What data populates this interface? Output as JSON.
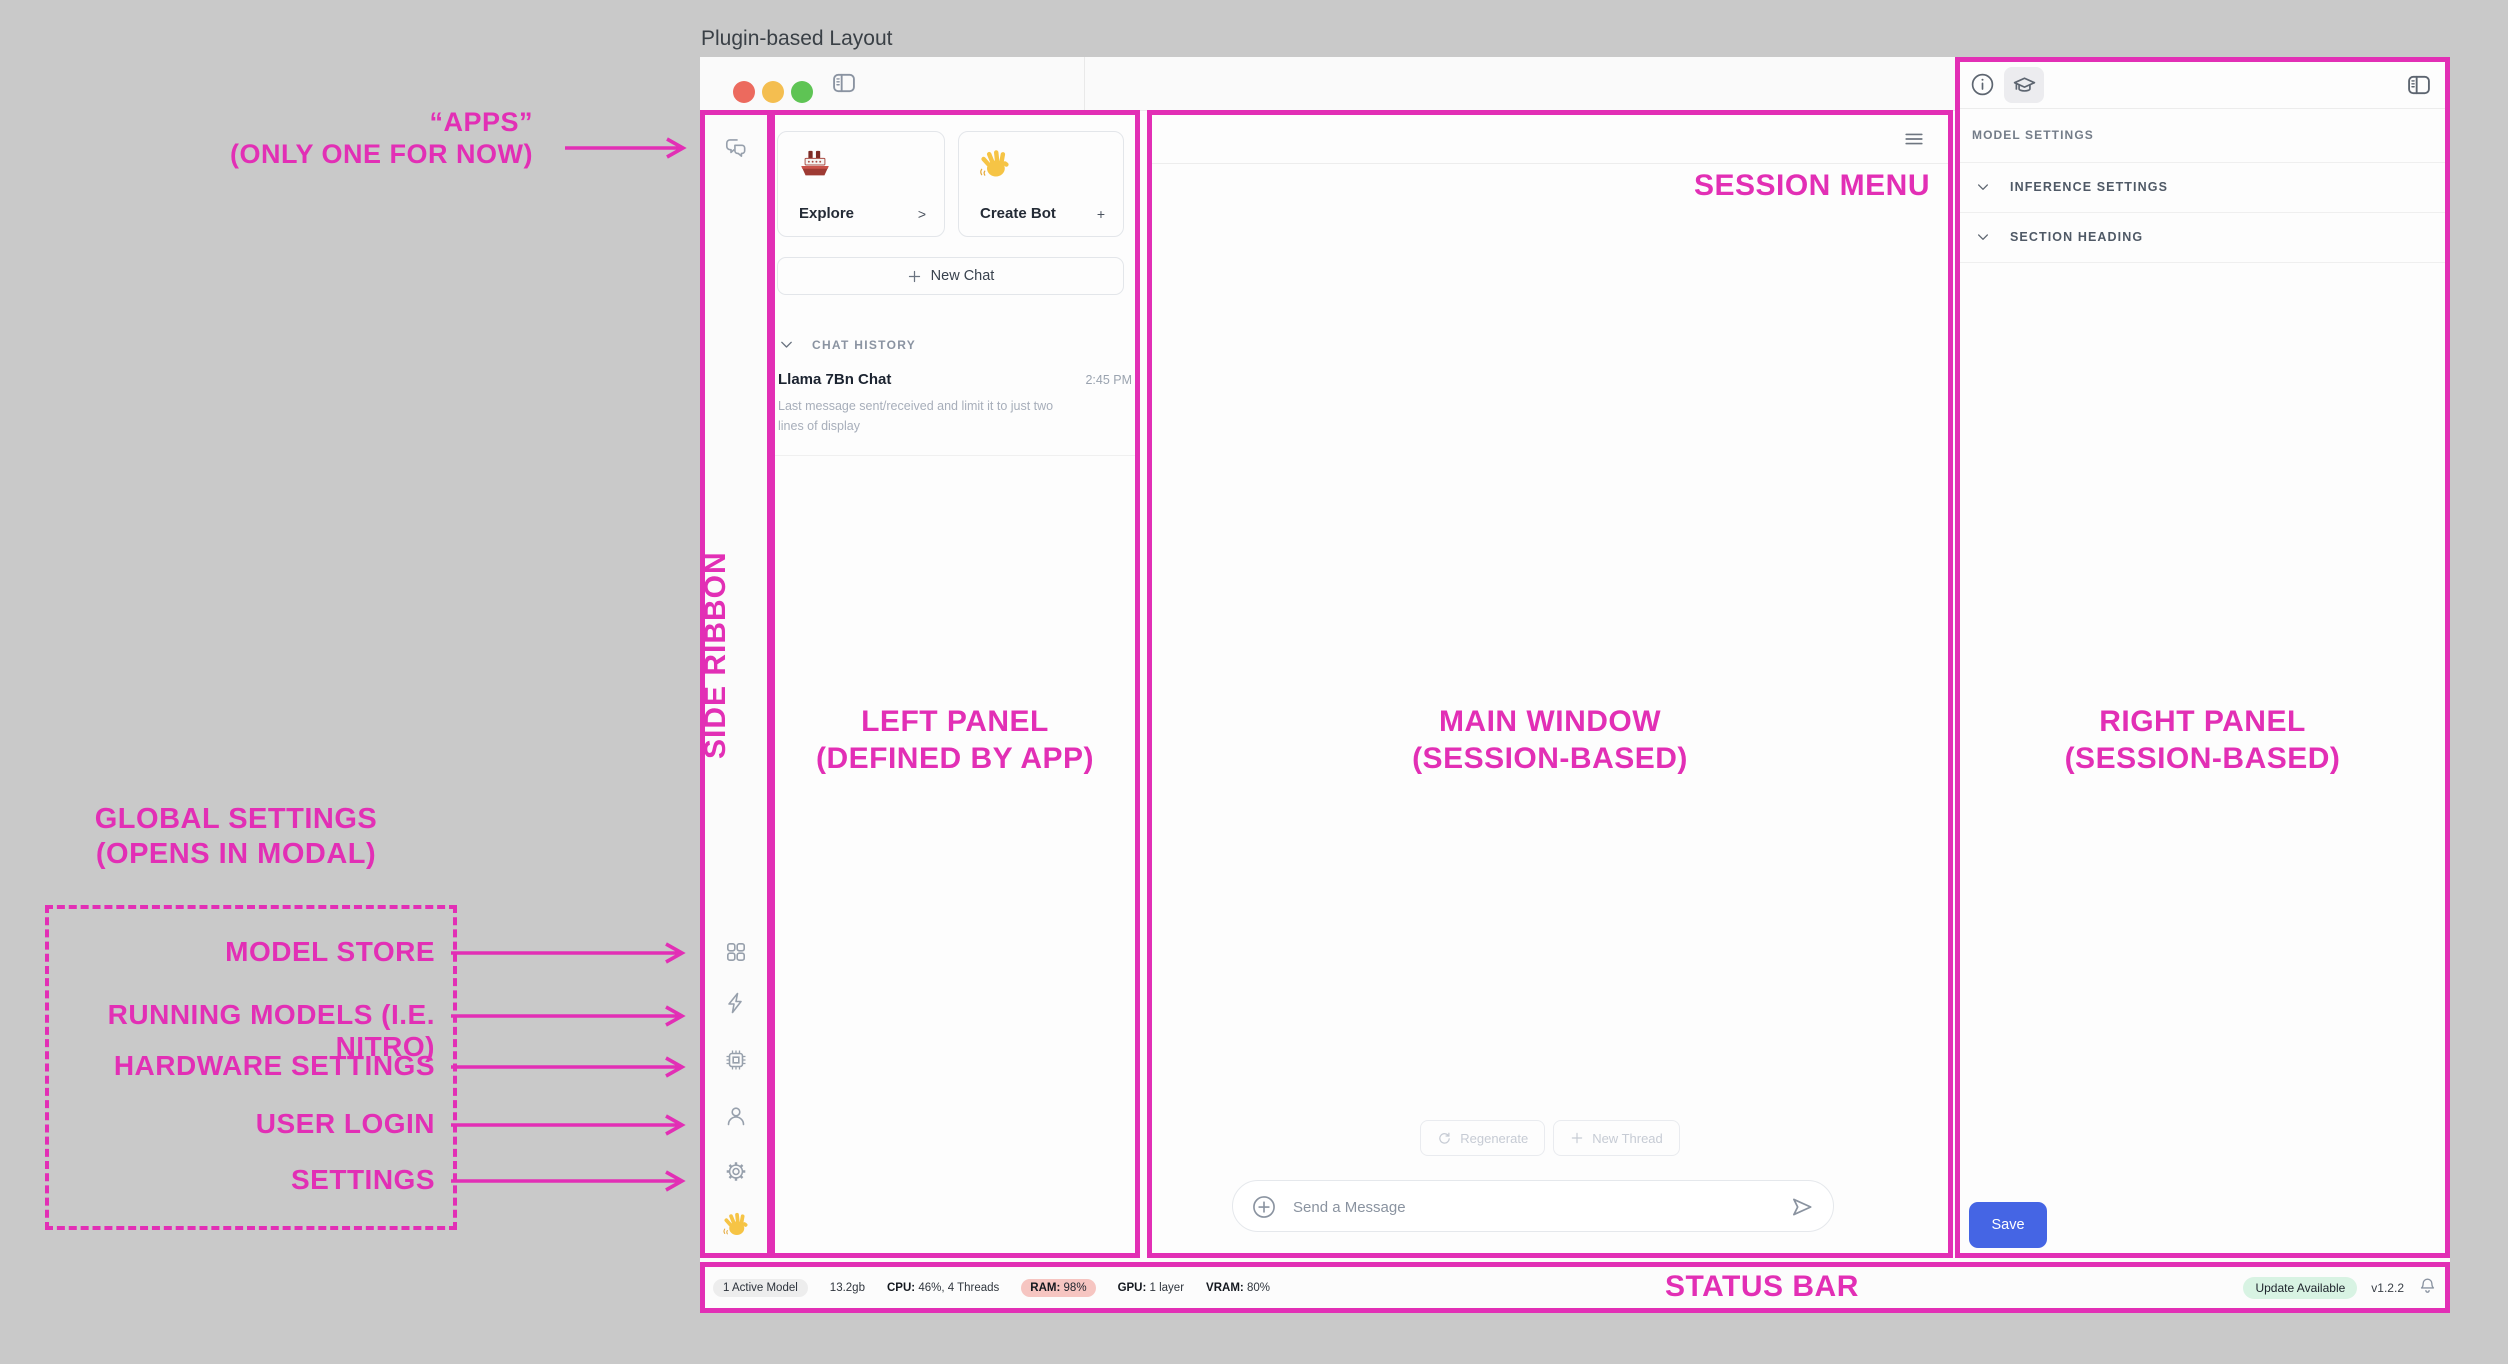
{
  "title": "Plugin-based Layout",
  "colors": {
    "annotation_pink": "#E22FB5",
    "save_button_blue": "#4565E4",
    "ram_pill_bg": "#F6C5C1",
    "update_pill_bg": "#D8F3E3",
    "traffic_red": "#EC6A5E",
    "traffic_yellow": "#F4BE50",
    "traffic_green": "#5EC454"
  },
  "annotations": {
    "apps_line1": "“APPS”",
    "apps_line2": "(ONLY ONE FOR NOW)",
    "global_line1": "GLOBAL SETTINGS",
    "global_line2": "(OPENS IN MODAL)",
    "modal_items": [
      "MODEL STORE",
      "RUNNING MODELS (I.E. NITRO)",
      "HARDWARE SETTINGS",
      "USER LOGIN",
      "SETTINGS"
    ],
    "side_ribbon": "SIDE RIBBON",
    "left_panel_line1": "LEFT PANEL",
    "left_panel_line2": "(DEFINED BY APP)",
    "main_window_line1": "MAIN WINDOW",
    "main_window_line2": "(SESSION-BASED)",
    "right_panel_line1": "RIGHT PANEL",
    "right_panel_line2": "(SESSION-BASED)",
    "session_menu": "SESSION MENU",
    "status_bar": "STATUS BAR"
  },
  "left_panel": {
    "explore_card": {
      "label": "Explore",
      "accessory": ">"
    },
    "create_bot_card": {
      "label": "Create Bot",
      "accessory": "+"
    },
    "new_chat_button": "New Chat",
    "chat_history_header": "CHAT HISTORY",
    "chat_item": {
      "title": "Llama 7Bn Chat",
      "time": "2:45 PM",
      "preview": "Last message sent/received and limit it to just two lines of display"
    }
  },
  "main_window": {
    "regenerate_button": "Regenerate",
    "new_thread_button": "New Thread",
    "message_placeholder": "Send a Message"
  },
  "right_panel": {
    "header": "MODEL SETTINGS",
    "sections": [
      "INFERENCE SETTINGS",
      "SECTION HEADING"
    ],
    "save_button": "Save"
  },
  "status_bar": {
    "active_model": "1 Active Model",
    "memory": "13.2gb",
    "cpu_label": "CPU:",
    "cpu_value": "46%, 4 Threads",
    "ram_label": "RAM:",
    "ram_value": "98%",
    "gpu_label": "GPU:",
    "gpu_value": "1 layer",
    "vram_label": "VRAM:",
    "vram_value": "80%",
    "update_badge": "Update Available",
    "version": "v1.2.2"
  }
}
